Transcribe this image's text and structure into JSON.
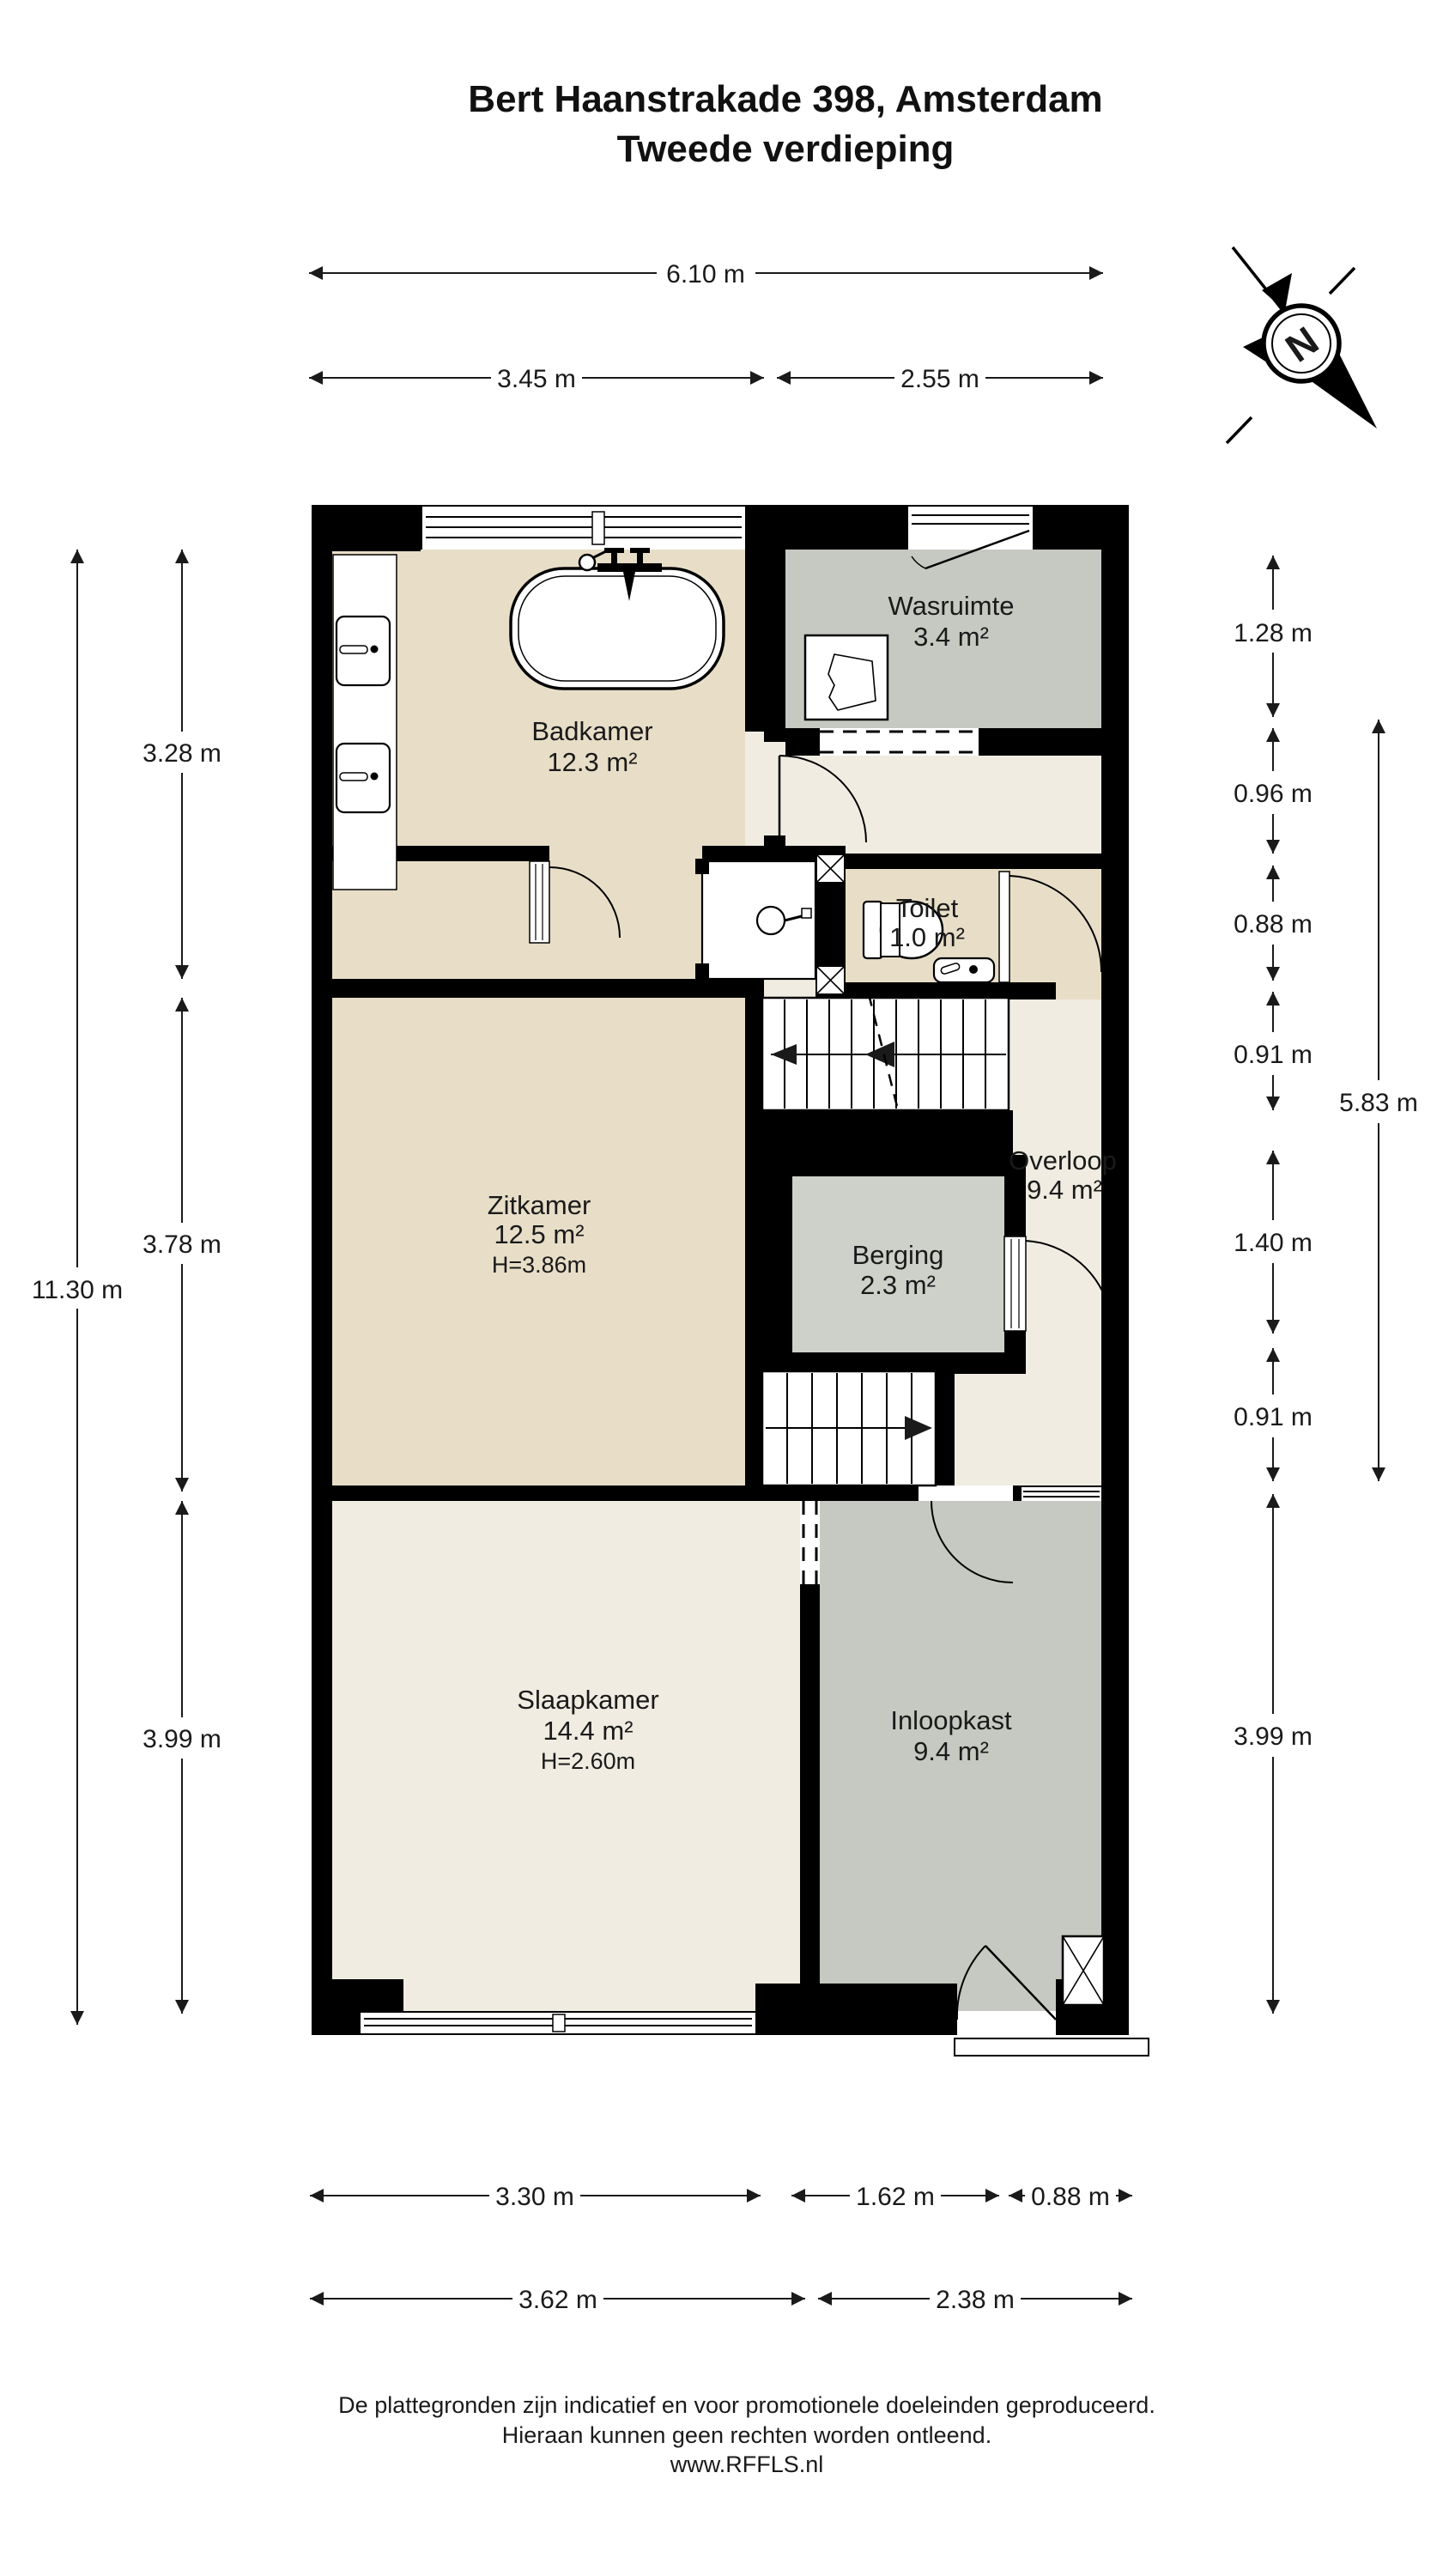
{
  "page": {
    "title_line1": "Bert Haanstrakade 398, Amsterdam",
    "title_line2": "Tweede verdieping"
  },
  "compass": {
    "north_label": "N"
  },
  "rooms": {
    "badkamer": {
      "name": "Badkamer",
      "area": "12.3 m²"
    },
    "wasruimte": {
      "name": "Wasruimte",
      "area": "3.4 m²"
    },
    "toilet": {
      "name": "Toilet",
      "area": "1.0 m²"
    },
    "overloop": {
      "name": "Overloop",
      "area": "9.4 m²"
    },
    "berging": {
      "name": "Berging",
      "area": "2.3 m²"
    },
    "zitkamer": {
      "name": "Zitkamer",
      "area": "12.5 m²",
      "height": "H=3.86m"
    },
    "slaapkamer": {
      "name": "Slaapkamer",
      "area": "14.4 m²",
      "height": "H=2.60m"
    },
    "inloopkast": {
      "name": "Inloopkast",
      "area": "9.4 m²"
    }
  },
  "dimensions": {
    "top": {
      "total": "6.10 m",
      "left": "3.45 m",
      "right": "2.55 m"
    },
    "left": {
      "total": "11.30 m",
      "segments": [
        "3.28 m",
        "3.78 m",
        "3.99 m"
      ]
    },
    "right": {
      "total": "5.83 m",
      "segments": [
        "1.28 m",
        "0.96 m",
        "0.88 m",
        "0.91 m",
        "1.40 m",
        "0.91 m",
        "3.99 m"
      ]
    },
    "bottom": {
      "row1": [
        "3.30 m",
        "1.62 m",
        "0.88 m"
      ],
      "row2": [
        "3.62 m",
        "2.38 m"
      ]
    }
  },
  "footer": {
    "line1": "De plattegronden zijn indicatief en voor promotionele doeleinden geproduceerd.",
    "line2": "Hieraan kunnen geen rechten worden ontleend.",
    "line3": "www.RFFLS.nl"
  },
  "colors": {
    "wall": "#000000",
    "beige": "#e8dec8",
    "gray": "#c6c9c1",
    "gray2": "#cdd1c9",
    "cream": "#f0ece1",
    "white": "#ffffff",
    "ink": "#1a1a1a"
  }
}
